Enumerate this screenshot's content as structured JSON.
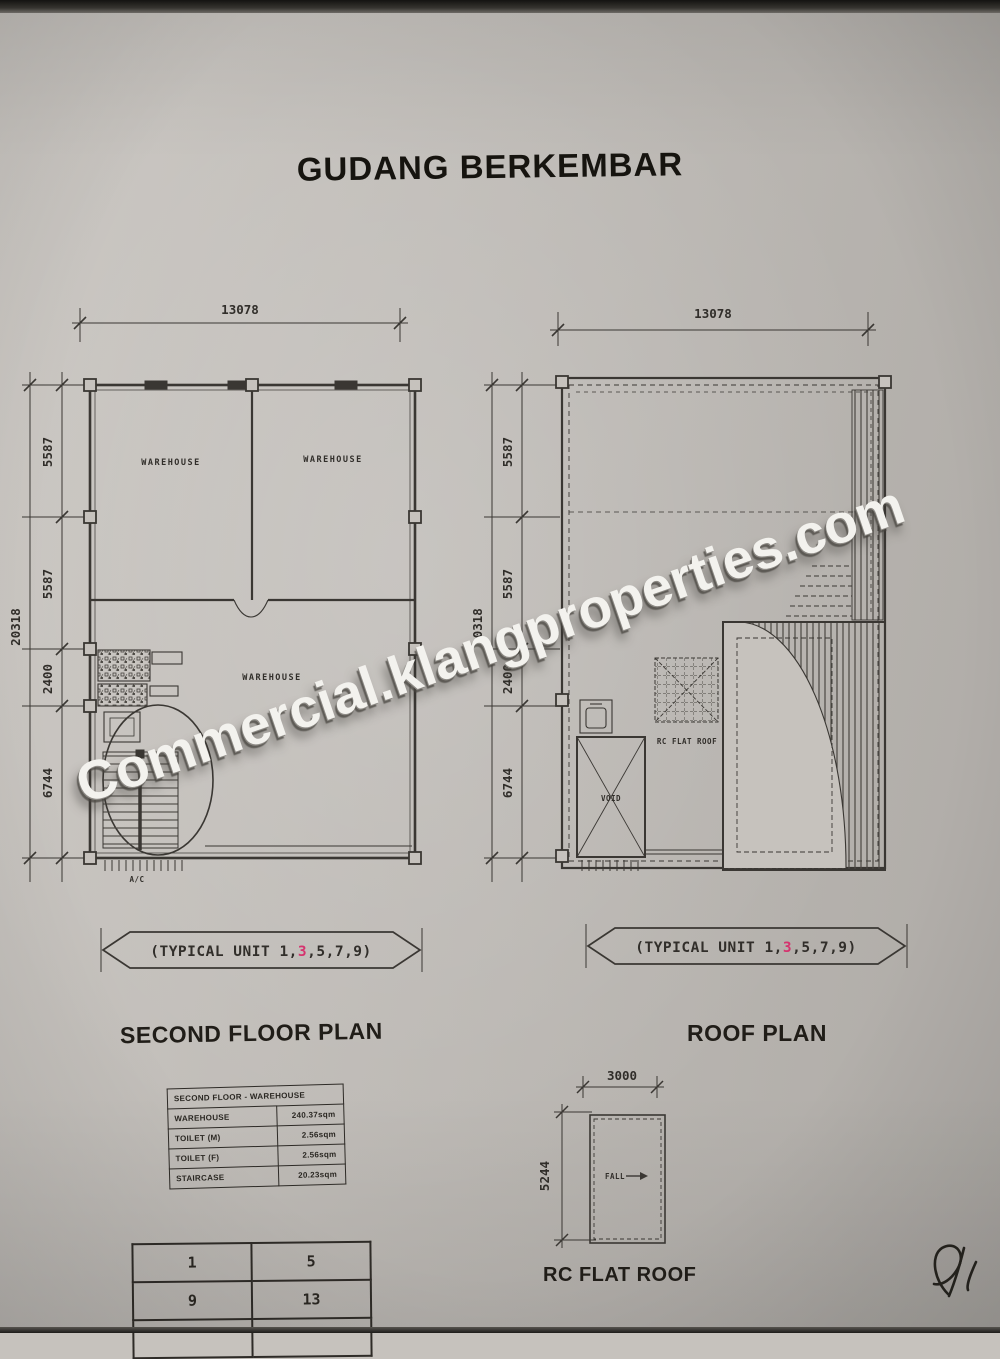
{
  "page": {
    "title": "GUDANG BERKEMBAR",
    "watermark": "Commercial.klangproperties.com"
  },
  "second_floor_plan": {
    "title": "SECOND FLOOR PLAN",
    "dim_width": "13078",
    "dim_height_total": "20318",
    "dim_segments": [
      "5587",
      "5587",
      "2400",
      "6744"
    ],
    "room_top_left": "WAREHOUSE",
    "room_top_right": "WAREHOUSE",
    "room_main": "WAREHOUSE",
    "ac_label": "A/C",
    "banner": {
      "pre": "(TYPICAL UNIT 1,",
      "highlight": "3",
      "post": ",5,7,9)"
    }
  },
  "roof_plan": {
    "title": "ROOF PLAN",
    "dim_width": "13078",
    "dim_height_total": "20318",
    "dim_segments": [
      "5587",
      "5587",
      "2400",
      "6744"
    ],
    "rc_flat_roof_label": "RC FLAT ROOF",
    "void_label": "VOID",
    "banner": {
      "pre": "(TYPICAL UNIT 1,",
      "highlight": "3",
      "post": ",5,7,9)"
    }
  },
  "area_table": {
    "header": "SECOND FLOOR - WAREHOUSE",
    "rows": [
      [
        "WAREHOUSE",
        "240.37sqm"
      ],
      [
        "TOILET (M)",
        "2.56sqm"
      ],
      [
        "TOILET (F)",
        "2.56sqm"
      ],
      [
        "STAIRCASE",
        "20.23sqm"
      ]
    ]
  },
  "unit_table": {
    "rows": [
      [
        "1",
        "5"
      ],
      [
        "9",
        "13"
      ]
    ]
  },
  "rc_flat_roof_plan": {
    "title": "RC FLAT ROOF",
    "dim_width": "3000",
    "dim_height": "5244",
    "fall_label": "FALL"
  },
  "colors": {
    "highlight_pink": "#d5336e",
    "paper": "#c6c2bd",
    "ink": "#3a3734"
  }
}
